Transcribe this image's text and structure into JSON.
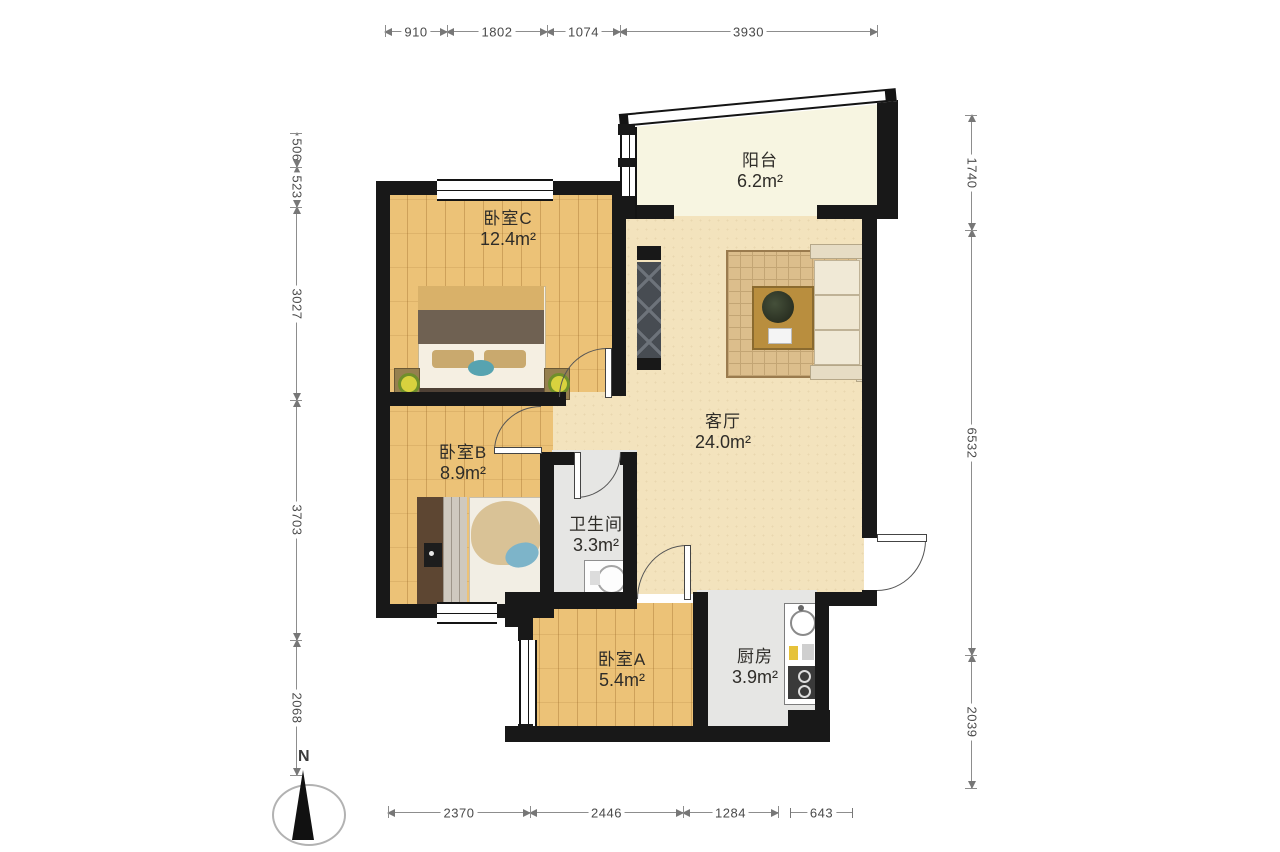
{
  "plan": {
    "type": "residential floor plan",
    "compass_label": "N"
  },
  "rooms": {
    "balcony": {
      "name": "阳台",
      "area": "6.2m²"
    },
    "bedroom_c": {
      "name": "卧室C",
      "area": "12.4m²"
    },
    "living": {
      "name": "客厅",
      "area": "24.0m²"
    },
    "bedroom_b": {
      "name": "卧室B",
      "area": "8.9m²"
    },
    "bathroom": {
      "name": "卫生间",
      "area": "3.3m²"
    },
    "bedroom_a": {
      "name": "卧室A",
      "area": "5.4m²"
    },
    "kitchen": {
      "name": "厨房",
      "area": "3.9m²"
    }
  },
  "dimensions": {
    "unit": "mm",
    "top": [
      "910",
      "1802",
      "1074",
      "3930"
    ],
    "bottom": [
      "2370",
      "2446",
      "1284",
      "643"
    ],
    "left": [
      "506",
      "523",
      "3027",
      "3703",
      "2068"
    ],
    "right": [
      "1740",
      "6532",
      "2039"
    ]
  },
  "colors": {
    "wall": "#181818",
    "wood_floor": "#ecc277",
    "living_floor": "#f3e3bd",
    "tile_floor": "#e6e6e4",
    "balcony_floor": "#f7f5e1",
    "dimension_line": "#8d8d8d"
  }
}
